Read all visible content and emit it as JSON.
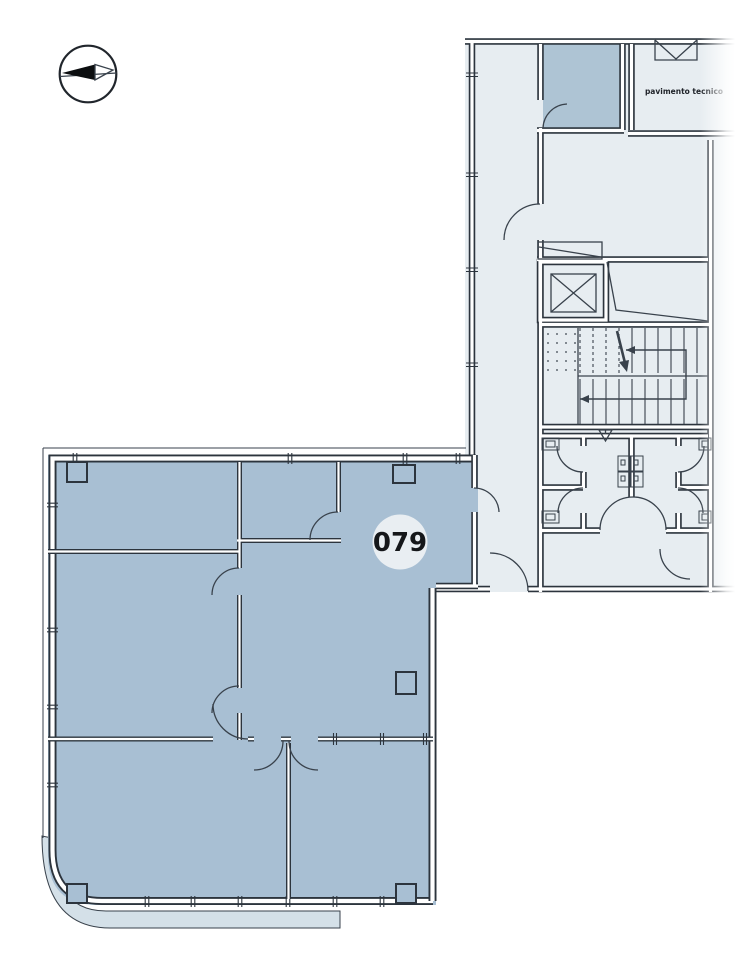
{
  "page": {
    "background": "#ffffff"
  },
  "unit": {
    "number": "079"
  },
  "labels": {
    "technical_room": "pavimento tecnico"
  },
  "icons": {
    "compass": "north-arrow"
  },
  "colors": {
    "page_bg": "#ffffff",
    "plan_light": "#e7edf1",
    "unit_fill": "#a8bfd3",
    "storage_fill": "#aec4d4",
    "terrace_fill": "#d4e0e8",
    "wall_dark": "#2c343d",
    "line_mid": "#39424c",
    "badge_fill": "#e9eef2",
    "badge_text": "#15171a"
  }
}
